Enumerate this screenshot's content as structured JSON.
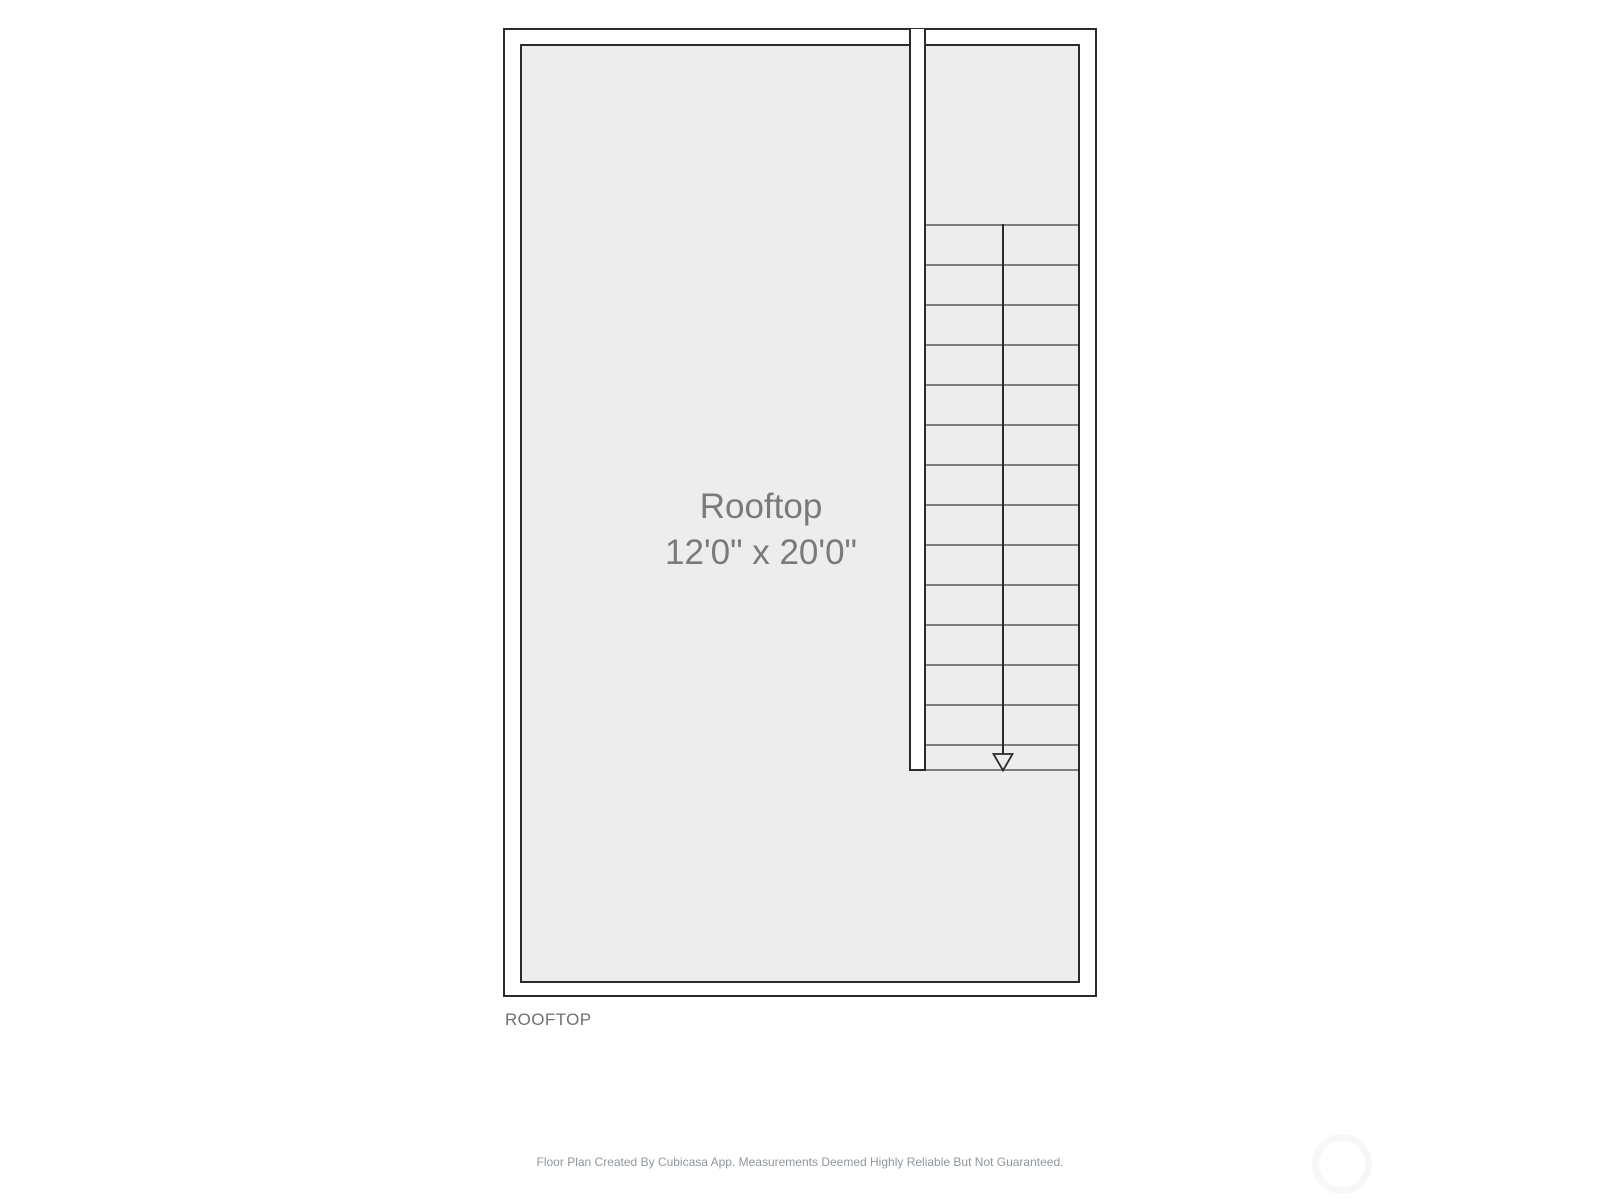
{
  "floor_plan": {
    "room": {
      "name": "Rooftop",
      "dimensions": "12'0\" x 20'0\""
    },
    "floor_label": "ROOFTOP",
    "stairs": {
      "direction": "down",
      "tread_count": 14
    },
    "colors": {
      "floor_fill": "#ededed",
      "wall": "#2b2b2b",
      "tread_line": "#7f7f7f",
      "room_text": "#7a7a7a",
      "floor_label_text": "#707070",
      "footer_text": "#8f969c"
    }
  },
  "footer": {
    "disclaimer": "Floor Plan Created By Cubicasa App. Measurements Deemed Highly Reliable But Not Guaranteed."
  }
}
